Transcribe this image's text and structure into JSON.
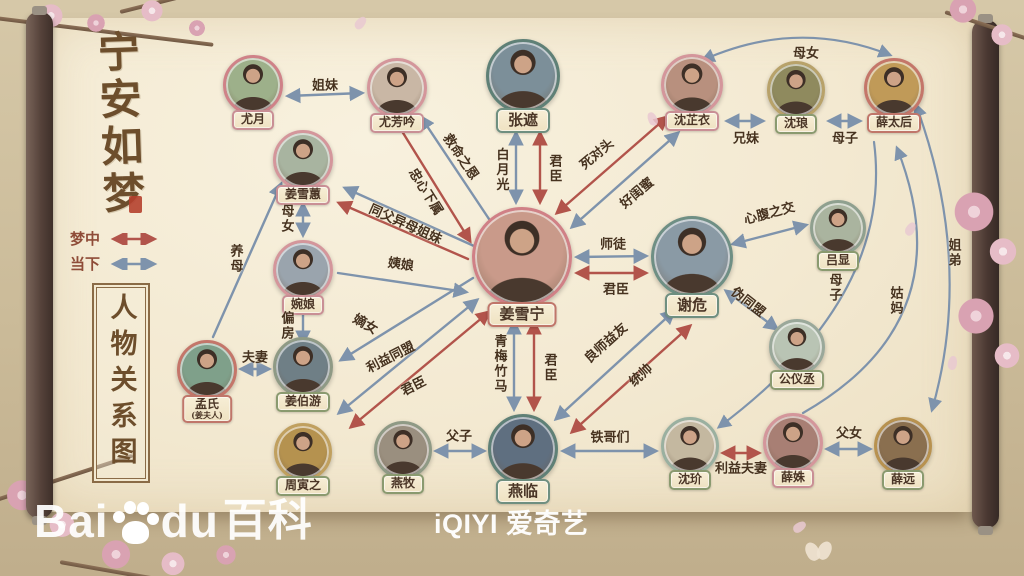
{
  "title": {
    "main": "宁安如梦",
    "side": "人物关系图"
  },
  "legend": {
    "items": [
      {
        "label": "梦中",
        "type": "dream"
      },
      {
        "label": "当下",
        "type": "present"
      }
    ]
  },
  "colors": {
    "dream": "#b2544b",
    "present": "#7e93ac",
    "label": "#46321f",
    "paper": "#f3e9d1",
    "seal": "#b5402e"
  },
  "footer": {
    "baidu_b1": "Bai",
    "baidu_b2": "du",
    "baidu_b3": "百科",
    "iqiyi": "iQIYI 爱奇艺"
  },
  "characters": [
    {
      "name": "尤月",
      "x": 253,
      "y": 85,
      "r": 30,
      "ring": "#cf8288",
      "plate": "#c98f95",
      "bg": "#9db08a"
    },
    {
      "name": "尤芳吟",
      "x": 397,
      "y": 88,
      "r": 30,
      "ring": "#d4969b",
      "plate": "#c98f95",
      "bg": "#c9b7a5"
    },
    {
      "name": "张遮",
      "x": 523,
      "y": 76,
      "r": 37,
      "ring": "#5f8076",
      "plate": "#6f8f80",
      "bg": "#7c8f99",
      "big": true
    },
    {
      "name": "沈芷衣",
      "x": 692,
      "y": 85,
      "r": 31,
      "ring": "#d4969b",
      "plate": "#c98f95",
      "bg": "#b8907e"
    },
    {
      "name": "沈琅",
      "x": 796,
      "y": 90,
      "r": 29,
      "ring": "#b8a26a",
      "plate": "#8a9a6f",
      "bg": "#8f8a5e"
    },
    {
      "name": "薛太后",
      "x": 894,
      "y": 88,
      "r": 30,
      "ring": "#c4766a",
      "plate": "#c0766a",
      "bg": "#c09a58"
    },
    {
      "name": "姜雪蕙",
      "x": 303,
      "y": 160,
      "r": 30,
      "ring": "#d4969b",
      "plate": "#c98f95",
      "bg": "#a8b4a0"
    },
    {
      "name": "婉娘",
      "x": 303,
      "y": 270,
      "r": 30,
      "ring": "#d4969b",
      "plate": "#c98f95",
      "bg": "#9aa4ad"
    },
    {
      "name": "姜雪宁",
      "x": 522,
      "y": 257,
      "r": 50,
      "ring": "#d08086",
      "plate": "#c0766a",
      "bg": "#c99a8a",
      "big": true
    },
    {
      "name": "谢危",
      "x": 692,
      "y": 257,
      "r": 41,
      "ring": "#6f8f84",
      "plate": "#6f8f80",
      "bg": "#8a9aa5",
      "big": true
    },
    {
      "name": "吕显",
      "x": 838,
      "y": 228,
      "r": 28,
      "ring": "#8fa08f",
      "plate": "#8a9a6f",
      "bg": "#aab49f"
    },
    {
      "name": "公仪丞",
      "x": 797,
      "y": 347,
      "r": 28,
      "ring": "#9aa89a",
      "plate": "#8a9a6f",
      "bg": "#b9c4b4"
    },
    {
      "name": "孟氏",
      "sub": "(姜夫人)",
      "x": 207,
      "y": 370,
      "r": 30,
      "ring": "#c4766a",
      "plate": "#c0766a",
      "bg": "#7fa08a"
    },
    {
      "name": "姜伯游",
      "x": 303,
      "y": 367,
      "r": 30,
      "ring": "#8f9a85",
      "plate": "#8a9a6f",
      "bg": "#6f7f86"
    },
    {
      "name": "周寅之",
      "x": 303,
      "y": 452,
      "r": 29,
      "ring": "#c0a05f",
      "plate": "#8a9a6f",
      "bg": "#b5924f"
    },
    {
      "name": "燕牧",
      "x": 403,
      "y": 450,
      "r": 29,
      "ring": "#8f9a85",
      "plate": "#8a9a6f",
      "bg": "#9a8f7f"
    },
    {
      "name": "燕临",
      "x": 523,
      "y": 449,
      "r": 35,
      "ring": "#5f8076",
      "plate": "#6f8f80",
      "bg": "#5f6f80",
      "big": true
    },
    {
      "name": "沈玠",
      "x": 690,
      "y": 446,
      "r": 29,
      "ring": "#9ab0a0",
      "plate": "#8a9a6f",
      "bg": "#c4b8a0"
    },
    {
      "name": "薛姝",
      "x": 793,
      "y": 443,
      "r": 30,
      "ring": "#d4969b",
      "plate": "#c98f95",
      "bg": "#a87f74"
    },
    {
      "name": "薛远",
      "x": 903,
      "y": 446,
      "r": 29,
      "ring": "#b8924f",
      "plate": "#8a9a6f",
      "bg": "#8a6f4f"
    }
  ],
  "relationships": [
    {
      "label": "姐妹",
      "type": "present",
      "heads": "both",
      "line": [
        288,
        96,
        362,
        93
      ],
      "lx": 325,
      "ly": 84,
      "rot": 0
    },
    {
      "label": "救命之恩",
      "type": "present",
      "heads": "start",
      "line": [
        421,
        117,
        489,
        219
      ],
      "lx": 462,
      "ly": 156,
      "rot": 56
    },
    {
      "label": "忠心下属",
      "type": "dream",
      "heads": "end",
      "line": [
        400,
        128,
        470,
        241
      ],
      "lx": 427,
      "ly": 191,
      "rot": 58
    },
    {
      "label": "白月光",
      "type": "present",
      "heads": "both",
      "line": [
        516,
        133,
        516,
        202
      ],
      "lx": 501,
      "ly": 170,
      "vert": true
    },
    {
      "label": "君臣",
      "type": "dream",
      "heads": "both",
      "line": [
        540,
        133,
        540,
        202
      ],
      "lx": 554,
      "ly": 169,
      "vert": true
    },
    {
      "label": "死对头",
      "type": "dream",
      "heads": "both",
      "line": [
        557,
        213,
        667,
        117
      ],
      "lx": 596,
      "ly": 153,
      "rot": -40
    },
    {
      "label": "好闺蜜",
      "type": "present",
      "heads": "both",
      "line": [
        572,
        227,
        678,
        133
      ],
      "lx": 636,
      "ly": 192,
      "rot": -40
    },
    {
      "label": "兄妹",
      "type": "present",
      "heads": "both",
      "line": [
        727,
        121,
        763,
        121
      ],
      "lx": 746,
      "ly": 137,
      "rot": 0
    },
    {
      "label": "母子",
      "type": "present",
      "heads": "both",
      "line": [
        829,
        121,
        860,
        121
      ],
      "lx": 845,
      "ly": 137,
      "rot": 0
    },
    {
      "label": "母女",
      "type": "present",
      "heads": "both",
      "curve": [
        703,
        60,
        797,
        18,
        890,
        55
      ],
      "lx": 806,
      "ly": 52,
      "rot": 0
    },
    {
      "label": "师徒",
      "type": "present",
      "heads": "both",
      "line": [
        577,
        257,
        646,
        256
      ],
      "lx": 613,
      "ly": 243,
      "rot": 0
    },
    {
      "label": "君臣",
      "type": "dream",
      "heads": "both",
      "line": [
        577,
        273,
        646,
        273
      ],
      "lx": 616,
      "ly": 288,
      "rot": 0
    },
    {
      "label": "心腹之交",
      "type": "present",
      "heads": "both",
      "line": [
        733,
        244,
        806,
        225
      ],
      "lx": 769,
      "ly": 212,
      "rot": -15
    },
    {
      "label": "伪同盟",
      "type": "present",
      "heads": "both",
      "line": [
        726,
        291,
        777,
        329
      ],
      "lx": 749,
      "ly": 301,
      "rot": 38
    },
    {
      "label": "同父异母姐妹",
      "type": "present",
      "heads": "start",
      "line": [
        345,
        188,
        474,
        246
      ],
      "lx": 406,
      "ly": 223,
      "rot": 24
    },
    {
      "label": "",
      "type": "dream",
      "heads": "start",
      "line": [
        339,
        203,
        468,
        259
      ],
      "lx": 0,
      "ly": 0,
      "rot": 0
    },
    {
      "label": "母女",
      "type": "present",
      "heads": "both",
      "line": [
        303,
        204,
        303,
        235
      ],
      "lx": 286,
      "ly": 219,
      "vert": true
    },
    {
      "label": "姨娘",
      "type": "present",
      "heads": "end",
      "line": [
        338,
        273,
        466,
        292
      ],
      "lx": 401,
      "ly": 263,
      "rot": 8
    },
    {
      "label": "养母",
      "type": "present",
      "heads": "end",
      "line": [
        213,
        337,
        281,
        184
      ],
      "lx": 235,
      "ly": 259,
      "vert": true
    },
    {
      "label": "偏房",
      "type": "present",
      "heads": "end",
      "line": [
        303,
        311,
        303,
        343
      ],
      "lx": 286,
      "ly": 326,
      "vert": true
    },
    {
      "label": "嫡女",
      "type": "present",
      "heads": "end",
      "line": [
        473,
        278,
        341,
        360
      ],
      "lx": 366,
      "ly": 323,
      "rot": 30
    },
    {
      "label": "利益同盟",
      "type": "present",
      "heads": "both",
      "line": [
        477,
        300,
        339,
        413
      ],
      "lx": 390,
      "ly": 356,
      "rot": -27
    },
    {
      "label": "君臣",
      "type": "dream",
      "heads": "both",
      "line": [
        489,
        312,
        351,
        427
      ],
      "lx": 413,
      "ly": 385,
      "rot": -27
    },
    {
      "label": "夫妻",
      "type": "present",
      "heads": "both",
      "line": [
        241,
        369,
        269,
        369
      ],
      "lx": 255,
      "ly": 356,
      "rot": 0
    },
    {
      "label": "青梅竹马",
      "type": "present",
      "heads": "both",
      "line": [
        514,
        322,
        514,
        409
      ],
      "lx": 499,
      "ly": 364,
      "vert": true
    },
    {
      "label": "君臣",
      "type": "dream",
      "heads": "both",
      "line": [
        534,
        322,
        534,
        409
      ],
      "lx": 549,
      "ly": 368,
      "vert": true
    },
    {
      "label": "良师益友",
      "type": "present",
      "heads": "both",
      "line": [
        556,
        419,
        674,
        311
      ],
      "lx": 605,
      "ly": 342,
      "rot": -42
    },
    {
      "label": "统帅",
      "type": "dream",
      "heads": "both",
      "line": [
        572,
        432,
        690,
        326
      ],
      "lx": 640,
      "ly": 374,
      "rot": -42
    },
    {
      "label": "父子",
      "type": "present",
      "heads": "both",
      "line": [
        436,
        451,
        484,
        451
      ],
      "lx": 459,
      "ly": 435,
      "rot": 0
    },
    {
      "label": "铁哥们",
      "type": "present",
      "heads": "both",
      "line": [
        563,
        451,
        656,
        451
      ],
      "lx": 610,
      "ly": 436,
      "rot": 0
    },
    {
      "label": "利益夫妻",
      "type": "dream",
      "heads": "both",
      "line": [
        723,
        453,
        759,
        453
      ],
      "lx": 741,
      "ly": 467,
      "rot": 0
    },
    {
      "label": "父女",
      "type": "present",
      "heads": "both",
      "line": [
        827,
        449,
        870,
        449
      ],
      "lx": 849,
      "ly": 432,
      "rot": 0
    },
    {
      "label": "母子",
      "type": "present",
      "heads": "end",
      "curve": [
        874,
        142,
        894,
        296,
        719,
        427
      ],
      "lx": 834,
      "ly": 288,
      "vert": true
    },
    {
      "label": "姑妈",
      "type": "present",
      "heads": "end",
      "curve": [
        803,
        413,
        965,
        320,
        897,
        148
      ],
      "lx": 895,
      "ly": 301,
      "vert": true
    },
    {
      "label": "姐弟",
      "type": "present",
      "heads": "both",
      "curve": [
        916,
        105,
        974,
        263,
        932,
        410
      ],
      "lx": 953,
      "ly": 253,
      "vert": true
    }
  ]
}
